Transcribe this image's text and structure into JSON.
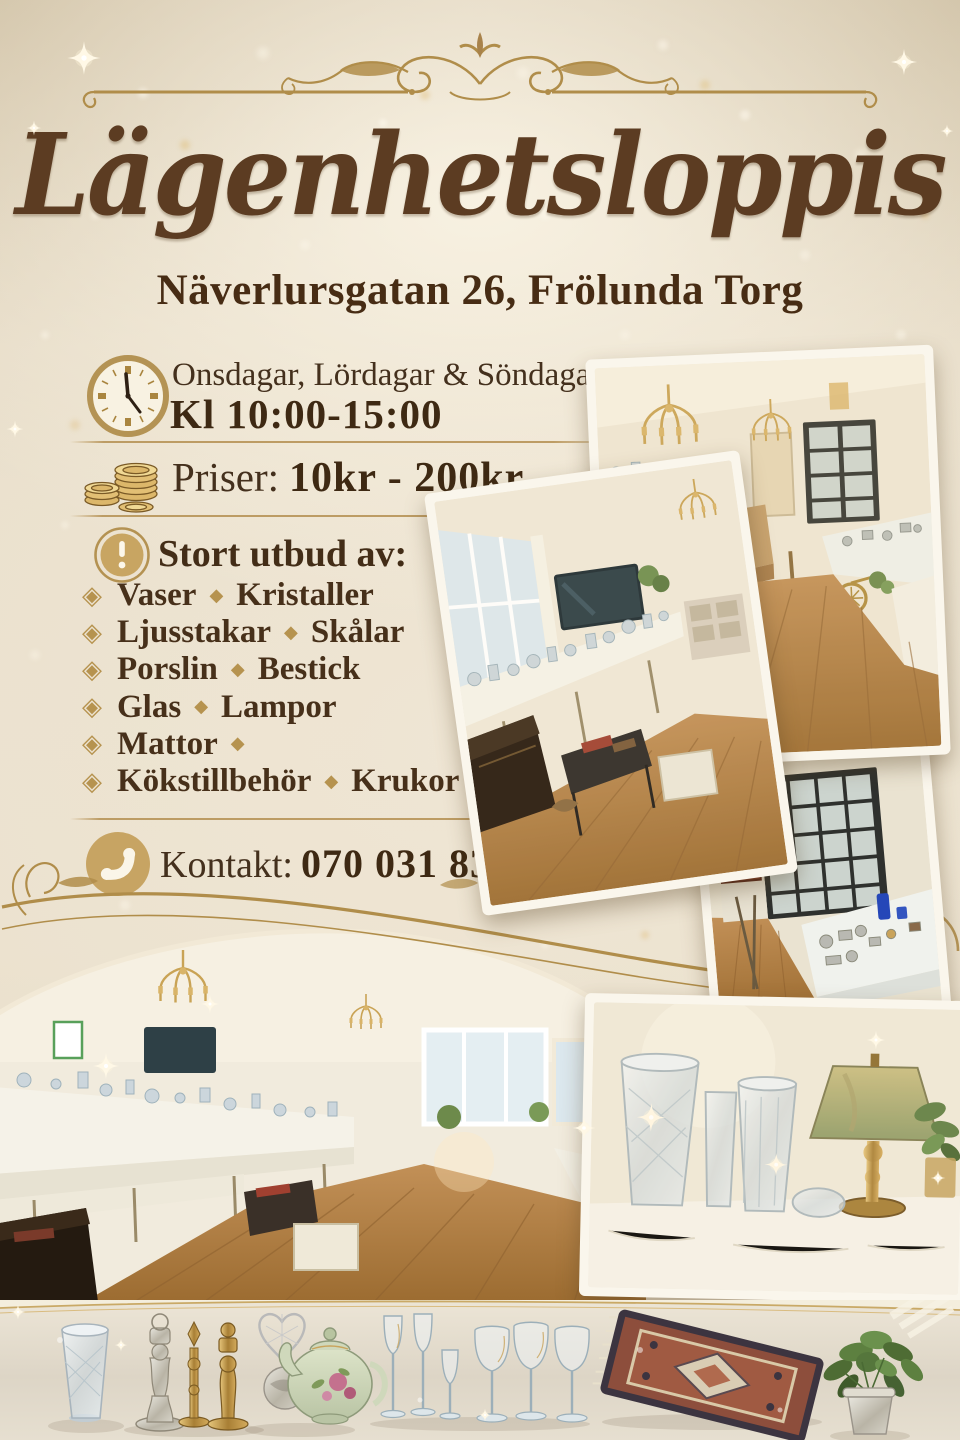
{
  "flyer": {
    "title": "Lägenhetsloppis",
    "address": "Näverlursgatan 26, Frölunda Torg",
    "schedule": {
      "days": "Onsdagar, Lördagar & Söndagar",
      "hours": "Kl 10:00-15:00"
    },
    "prices": {
      "label": "Priser:",
      "value": "10kr - 200kr"
    },
    "assortment": {
      "heading": "Stort utbud av:",
      "bullet_char": "◈",
      "separator_char": "◆",
      "items": [
        {
          "first": "Vaser",
          "second": "Kristaller"
        },
        {
          "first": "Ljusstakar",
          "second": "Skålar"
        },
        {
          "first": "Porslin",
          "second": "Bestick"
        },
        {
          "first": "Glas",
          "second": "Lampor"
        },
        {
          "first": "Mattor",
          "second": ""
        },
        {
          "first": "Kökstillbehör",
          "second": "Krukor"
        }
      ]
    },
    "contact": {
      "label": "Kontakt:",
      "phone": "070 031 83 46"
    },
    "icons": {
      "schedule": "clock-icon",
      "prices": "coins-icon",
      "assortment": "alert-icon",
      "contact": "phone-icon",
      "bullet": "diamond-bullet-icon"
    },
    "photos": [
      {
        "name": "photo-interior-hall",
        "description": "Room with chandeliers, long tables of glassware and wooden floor"
      },
      {
        "name": "photo-interior-window",
        "description": "Room with bright window, TV and long table of glassware"
      },
      {
        "name": "photo-display-cabinets",
        "description": "Black glass display cabinets with porcelain and blue glass"
      },
      {
        "name": "photo-interior-panorama",
        "description": "Long room with tables full of crystal glassware and wooden floor"
      },
      {
        "name": "photo-crystal-and-lamp",
        "description": "Crystal vases, brass table lamp with green shade and a plant"
      },
      {
        "name": "photo-items-row",
        "description": "Crystal vase, candlesticks, teapot, wine glasses, oriental rug and potted plant"
      }
    ],
    "colors": {
      "gold": "#b5935a",
      "icon_gold": "#c7a463",
      "text_brown": "#46301c",
      "title_brown": "#5c3c22",
      "background": "#e7ddca",
      "photo_border": "#faf6ec"
    }
  }
}
